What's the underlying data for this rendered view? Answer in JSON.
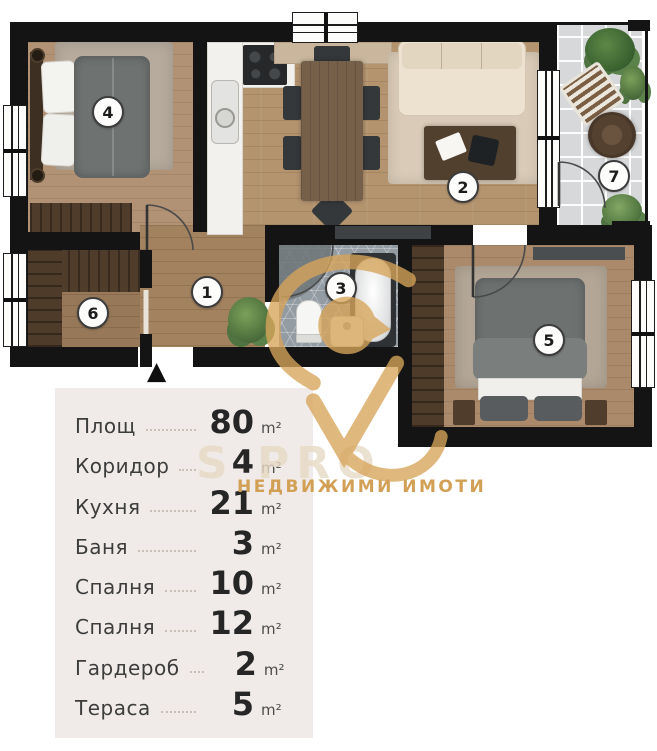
{
  "legend": {
    "panel_color": "#f0ebe8",
    "rows": [
      {
        "label": "Площ",
        "value": "80",
        "unit": "m²"
      },
      {
        "label": "Коридор",
        "value": "4",
        "unit": "m²"
      },
      {
        "label": "Кухня",
        "value": "21",
        "unit": "m²"
      },
      {
        "label": "Баня",
        "value": "3",
        "unit": "m²"
      },
      {
        "label": "Спалня",
        "value": "10",
        "unit": "m²"
      },
      {
        "label": "Спалня",
        "value": "12",
        "unit": "m²"
      },
      {
        "label": "Гардероб",
        "value": "2",
        "unit": "m²"
      },
      {
        "label": "Тераса",
        "value": "5",
        "unit": "m²"
      }
    ]
  },
  "floorplan": {
    "wall_color": "#141414",
    "entrance_marker": "▲",
    "room_numbers": [
      "1",
      "2",
      "3",
      "4",
      "5",
      "6",
      "7"
    ]
  },
  "watermark": {
    "brand_ghost": "S PRO",
    "tagline": "НЕДВИЖИМИ ИМОТИ",
    "gold": "#d5a255"
  }
}
